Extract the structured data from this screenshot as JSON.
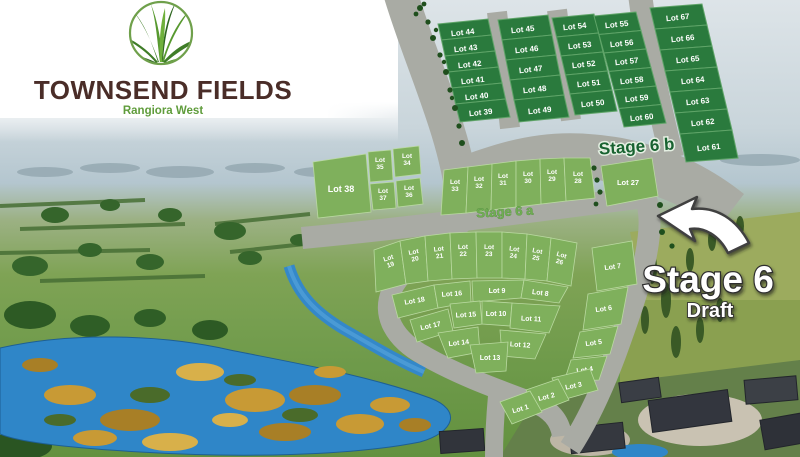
{
  "branding": {
    "title": "TOWNSEND FIELDS",
    "subtitle": "Rangiora West"
  },
  "labels": {
    "stage6a": "Stage 6 a",
    "stage6b": "Stage 6 b",
    "headline": "Stage 6",
    "headline_sub": "Draft"
  },
  "colors": {
    "dark_lot": "#2a7a3d",
    "dark_lot_border": "#5fa468",
    "light_lot": "#7fb05c",
    "light_lot_border": "#b9d9a0",
    "road": "#a9aba4",
    "stage6b_text": "#186230",
    "stage6a_text": "#6fae52",
    "pond": "#2f86c8",
    "logo_green": "#57992f",
    "brand_brown": "#4a2d28"
  },
  "stage6b_lots": [
    {
      "label": "Lot 44",
      "pts": "438,24 488,19 491.5,35 441.5,40",
      "lx": 463,
      "ly": 35,
      "rot": -6,
      "fs": 8
    },
    {
      "label": "Lot 43",
      "pts": "441.5,40 491.5,35 495,51 445,56",
      "lx": 466,
      "ly": 51,
      "rot": -6,
      "fs": 8
    },
    {
      "label": "Lot 42",
      "pts": "445,56 495,51 498.5,67 448.5,72",
      "lx": 470,
      "ly": 67,
      "rot": -6,
      "fs": 8
    },
    {
      "label": "Lot 41",
      "pts": "448.5,72 498.5,67 502,83 452,88",
      "lx": 473,
      "ly": 83,
      "rot": -6,
      "fs": 8
    },
    {
      "label": "Lot 40",
      "pts": "452,88 502,83 505.5,99 455.5,104",
      "lx": 477,
      "ly": 99,
      "rot": -6,
      "fs": 8
    },
    {
      "label": "Lot 39",
      "pts": "455.5,104 505.5,99 510,117 460,122",
      "lx": 481,
      "ly": 115,
      "rot": -6,
      "fs": 8
    },
    {
      "label": "Lot 45",
      "pts": "498,20 548,15 552,35 502,40",
      "lx": 523,
      "ly": 32,
      "rot": -6,
      "fs": 8
    },
    {
      "label": "Lot 46",
      "pts": "502,40 552,35 556,55 506,60",
      "lx": 527,
      "ly": 52,
      "rot": -6,
      "fs": 8
    },
    {
      "label": "Lot 47",
      "pts": "506,60 556,55 560,75 510,80",
      "lx": 531,
      "ly": 72,
      "rot": -6,
      "fs": 8
    },
    {
      "label": "Lot 48",
      "pts": "510,80 560,75 564,95 514,100",
      "lx": 535,
      "ly": 92,
      "rot": -6,
      "fs": 8
    },
    {
      "label": "Lot 49",
      "pts": "514,100 564,95 569,117 519,122",
      "lx": 540,
      "ly": 113,
      "rot": -6,
      "fs": 8
    },
    {
      "label": "Lot 54",
      "pts": "552,18 594,14 598.5,33 556.5,37",
      "lx": 575,
      "ly": 29,
      "rot": -6,
      "fs": 8
    },
    {
      "label": "Lot 53",
      "pts": "556.5,37 598.5,33 603,52 561,56",
      "lx": 580,
      "ly": 48,
      "rot": -6,
      "fs": 8
    },
    {
      "label": "Lot 52",
      "pts": "561,56 603,52 607.5,71 565.5,75",
      "lx": 584,
      "ly": 67,
      "rot": -6,
      "fs": 8
    },
    {
      "label": "Lot 51",
      "pts": "565.5,75 607.5,71 612,90 570,94",
      "lx": 589,
      "ly": 86,
      "rot": -6,
      "fs": 8
    },
    {
      "label": "Lot 50",
      "pts": "570,94 612,90 617,111 575,115",
      "lx": 593,
      "ly": 106,
      "rot": -6,
      "fs": 8
    },
    {
      "label": "Lot 55",
      "pts": "594,16 636,12 641,30.5 599,34.5",
      "lx": 617,
      "ly": 27,
      "rot": -6,
      "fs": 8
    },
    {
      "label": "Lot 56",
      "pts": "599,34.5 641,30.5 646,49 604,53",
      "lx": 622,
      "ly": 46,
      "rot": -6,
      "fs": 8
    },
    {
      "label": "Lot 57",
      "pts": "604,53 646,49 651,67.5 609,71.5",
      "lx": 627,
      "ly": 64,
      "rot": -6,
      "fs": 8
    },
    {
      "label": "Lot 58",
      "pts": "609,71.5 651,67.5 656,86 614,90",
      "lx": 632,
      "ly": 83,
      "rot": -6,
      "fs": 8
    },
    {
      "label": "Lot 59",
      "pts": "614,90 656,86 661,104.5 619,108.5",
      "lx": 637,
      "ly": 101,
      "rot": -6,
      "fs": 8
    },
    {
      "label": "Lot 60",
      "pts": "619,108.5 661,104.5 666,123 624,127",
      "lx": 642,
      "ly": 120,
      "rot": -6,
      "fs": 8
    },
    {
      "label": "Lot 67",
      "pts": "650,8 702,4 707,25 655,29",
      "lx": 678,
      "ly": 20,
      "rot": -6,
      "fs": 8
    },
    {
      "label": "Lot 66",
      "pts": "655,29 707,25 712,46 660,50",
      "lx": 683,
      "ly": 41,
      "rot": -6,
      "fs": 8
    },
    {
      "label": "Lot 65",
      "pts": "660,50 712,46 717,67 665,71",
      "lx": 688,
      "ly": 62,
      "rot": -6,
      "fs": 8
    },
    {
      "label": "Lot 64",
      "pts": "665,71 717,67 722,88 670,92",
      "lx": 693,
      "ly": 83,
      "rot": -6,
      "fs": 8
    },
    {
      "label": "Lot 63",
      "pts": "670,92 722,88 727,109 675,113",
      "lx": 698,
      "ly": 104,
      "rot": -6,
      "fs": 8
    },
    {
      "label": "Lot 62",
      "pts": "675,113 727,109 732,130 680,134",
      "lx": 703,
      "ly": 125,
      "rot": -6,
      "fs": 8
    },
    {
      "label": "Lot 61",
      "pts": "680,134 732,130 738,158 686,162",
      "lx": 709,
      "ly": 150,
      "rot": -6,
      "fs": 8
    }
  ],
  "stage6a_lots": [
    {
      "label": "Lot 38",
      "pts": "313,162 366,154 371,212 318,218",
      "lx": 341,
      "ly": 192,
      "fs": 9
    },
    {
      "label": "Lot 35",
      "pts": "368,152 391,150 393,180 370,182",
      "lx": 380,
      "ly": 162,
      "fs": 6.5,
      "stack": true
    },
    {
      "label": "Lot 34",
      "pts": "393,149 419,146 421,174 395,177",
      "lx": 407,
      "ly": 158,
      "fs": 6.5,
      "stack": true
    },
    {
      "label": "Lot 37",
      "pts": "370,184 394,182 396,208 373,210",
      "lx": 383,
      "ly": 193,
      "fs": 6.5,
      "stack": true
    },
    {
      "label": "Lot 36",
      "pts": "396,181 420,178 423,204 398,207",
      "lx": 409,
      "ly": 190,
      "fs": 6.5,
      "stack": true
    },
    {
      "label": "Lot 33",
      "pts": "444,170 468,167 466,213 441,215",
      "lx": 455,
      "ly": 184,
      "fs": 6.5,
      "stack": true
    },
    {
      "label": "Lot 32",
      "pts": "468,167 492,164 491,210 466,213",
      "lx": 479,
      "ly": 181,
      "fs": 6.5,
      "stack": true
    },
    {
      "label": "Lot 31",
      "pts": "492,164 516,161 516,207 491,210",
      "lx": 503,
      "ly": 178,
      "fs": 6.5,
      "stack": true
    },
    {
      "label": "Lot 30",
      "pts": "516,161 540,159 541,204 516,207",
      "lx": 528,
      "ly": 176,
      "fs": 6.5,
      "stack": true
    },
    {
      "label": "Lot 29",
      "pts": "540,159 564,158 566,201 541,204",
      "lx": 552,
      "ly": 174,
      "fs": 6.5,
      "stack": true
    },
    {
      "label": "Lot 28",
      "pts": "564,158 590,158 595,198 566,201",
      "lx": 578,
      "ly": 176,
      "fs": 6.5,
      "stack": true
    },
    {
      "label": "Lot 27",
      "pts": "601,166 652,158 658,196 607,206",
      "lx": 628,
      "ly": 185,
      "fs": 7.5
    },
    {
      "label": "Lot 19",
      "pts": "374,250 400,241 406,284 376,292",
      "lx": 389,
      "ly": 260,
      "rot": -18,
      "fs": 6.5,
      "stack": true
    },
    {
      "label": "Lot 20",
      "pts": "400,241 425,236 428,281 406,284",
      "lx": 414,
      "ly": 254,
      "rot": -12,
      "fs": 6.5,
      "stack": true
    },
    {
      "label": "Lot 21",
      "pts": "425,236 450,233 452,279 428,281",
      "lx": 439,
      "ly": 251,
      "rot": -7,
      "fs": 6.5,
      "stack": true
    },
    {
      "label": "Lot 22",
      "pts": "450,233 476,232 477,278 452,279",
      "lx": 463,
      "ly": 249,
      "rot": -2,
      "fs": 6.5,
      "stack": true
    },
    {
      "label": "Lot 23",
      "pts": "476,232 502,232 502,278 477,278",
      "lx": 489,
      "ly": 249,
      "rot": 2,
      "fs": 6.5,
      "stack": true
    },
    {
      "label": "Lot 24",
      "pts": "502,232 527,234 525,279 502,278",
      "lx": 514,
      "ly": 251,
      "rot": 7,
      "fs": 6.5,
      "stack": true
    },
    {
      "label": "Lot 25",
      "pts": "527,234 551,238 547,281 525,279",
      "lx": 537,
      "ly": 253,
      "rot": 12,
      "fs": 6.5,
      "stack": true
    },
    {
      "label": "Lot 26",
      "pts": "551,238 577,243 571,286 547,281",
      "lx": 561,
      "ly": 257,
      "rot": 17,
      "fs": 6.5,
      "stack": true
    },
    {
      "label": "Lot 18",
      "pts": "392,295 434,285 438,308 398,318",
      "lx": 415,
      "ly": 303,
      "rot": -10,
      "fs": 7
    },
    {
      "label": "Lot 16",
      "pts": "434,285 470,281 471,302 438,308",
      "lx": 452,
      "ly": 296,
      "rot": -4,
      "fs": 7
    },
    {
      "label": "Lot 9",
      "pts": "472,281 524,280 521,298 473,302",
      "lx": 497,
      "ly": 293,
      "fs": 7
    },
    {
      "label": "Lot 8",
      "pts": "524,280 568,287 559,303 521,298",
      "lx": 540,
      "ly": 295,
      "rot": 8,
      "fs": 7
    },
    {
      "label": "Lot 17",
      "pts": "410,320 448,309 453,331 417,342",
      "lx": 431,
      "ly": 328,
      "rot": -12,
      "fs": 7
    },
    {
      "label": "Lot 15",
      "pts": "450,304 480,301 482,324 454,328",
      "lx": 466,
      "ly": 317,
      "rot": -3,
      "fs": 7
    },
    {
      "label": "Lot 10",
      "pts": "482,301 512,303 510,326 482,324",
      "lx": 496,
      "ly": 316,
      "fs": 7
    },
    {
      "label": "Lot 11",
      "pts": "512,303 560,306 549,333 510,328",
      "lx": 531,
      "ly": 321,
      "rot": 3,
      "fs": 7
    },
    {
      "label": "Lot 14",
      "pts": "438,333 478,327 480,352 448,358",
      "lx": 459,
      "ly": 345,
      "rot": -6,
      "fs": 7
    },
    {
      "label": "Lot 12",
      "pts": "500,330 546,334 535,359 502,356",
      "lx": 520,
      "ly": 347,
      "rot": 4,
      "fs": 7
    },
    {
      "label": "Lot 13",
      "pts": "470,345 508,342 506,371 476,373",
      "lx": 490,
      "ly": 360,
      "fs": 7
    },
    {
      "label": "Lot 7",
      "pts": "592,248 632,241 637,284 597,291",
      "lx": 613,
      "ly": 269,
      "rot": -8,
      "fs": 7
    },
    {
      "label": "Lot 6",
      "pts": "588,294 628,287 621,324 583,330",
      "lx": 604,
      "ly": 311,
      "rot": -8,
      "fs": 7
    },
    {
      "label": "Lot 5",
      "pts": "580,332 618,326 610,354 573,358",
      "lx": 594,
      "ly": 345,
      "rot": -8,
      "fs": 7
    },
    {
      "label": "Lot 4",
      "pts": "571,360 607,356 599,380 564,382",
      "lx": 585,
      "ly": 372,
      "rot": -8,
      "fs": 7
    },
    {
      "label": "Lot 3",
      "pts": "552,378 590,369 598,390 562,400",
      "lx": 574,
      "ly": 388,
      "rot": -12,
      "fs": 7
    },
    {
      "label": "Lot 2",
      "pts": "526,390 558,379 569,400 538,412",
      "lx": 547,
      "ly": 399,
      "rot": -14,
      "fs": 7
    },
    {
      "label": "Lot 1",
      "pts": "500,402 530,391 542,412 512,424",
      "lx": 521,
      "ly": 411,
      "rot": -16,
      "fs": 7
    }
  ]
}
